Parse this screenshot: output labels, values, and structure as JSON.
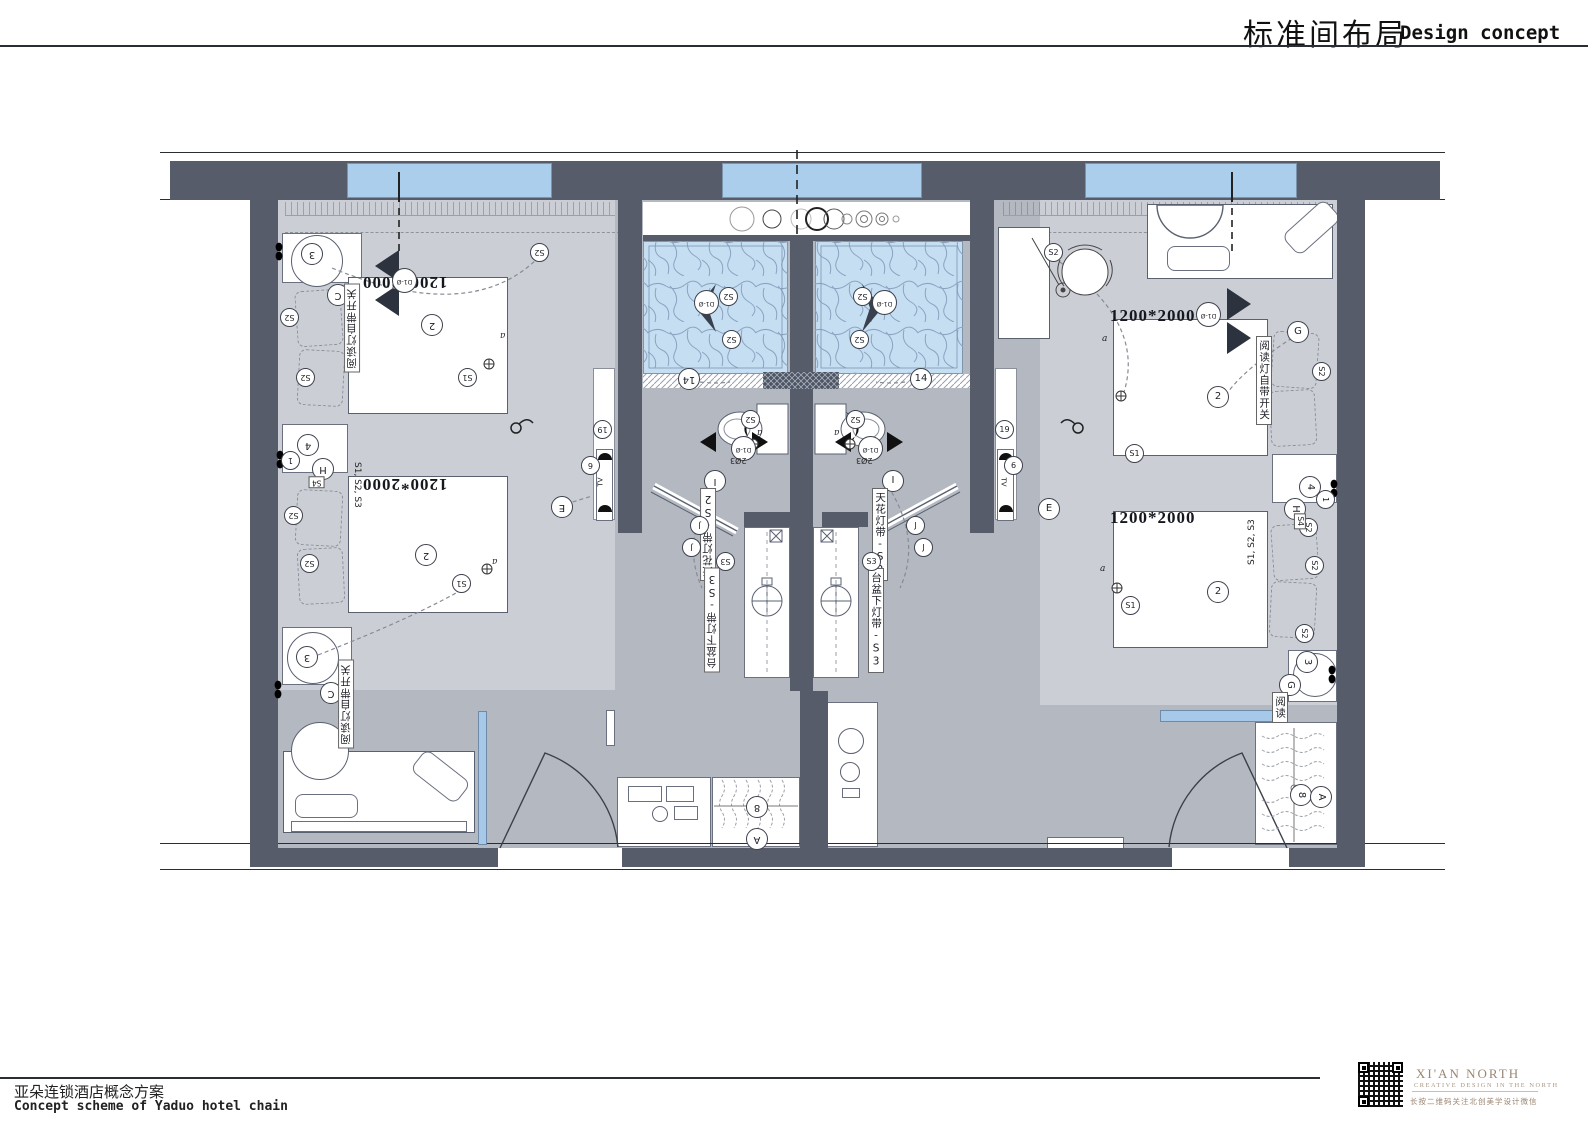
{
  "header": {
    "title_cn": "标准间布局",
    "title_en": "Design concept"
  },
  "footer": {
    "project_cn": "亚朵连锁酒店概念方案",
    "project_en": "Concept scheme of Yaduo hotel chain"
  },
  "brand": {
    "name": "XI'AN NORTH",
    "tagline": "CREATIVE DESIGN IN THE NORTH",
    "wechat_note": "长按二维码关注北创美学设计微信"
  },
  "plan": {
    "bed_size": "1200*2000",
    "reading_lamp_note": "阅读灯自带开关",
    "reading_short": "阅读",
    "ceiling_strip": "天花灯带-S2",
    "basin_strip": "台盆下灯带-S3",
    "switch_group": "S1, S2, S3",
    "door_mark": "D1-Ø",
    "toilet_mark": "2Ø3",
    "tv": "TV",
    "circles": {
      "n1": "1",
      "n2": "2",
      "n3": "3",
      "n4": "4",
      "n6": "6",
      "n8": "8",
      "n14": "14",
      "n19": "19",
      "a": "A",
      "c": "C",
      "e": "E",
      "g": "G",
      "h": "H",
      "i": "I",
      "j": "J"
    },
    "tags": {
      "s1": "S1",
      "s2": "S2",
      "s3": "S3",
      "s4": "S4",
      "sw_a": "a"
    }
  },
  "colors": {
    "wall": "#565c6a",
    "window": "#abceec",
    "floor_light": "#cbcfd5",
    "floor_dark": "#b4b8c1",
    "shower": "#c6def2",
    "accent": "#a6c9e9",
    "brand_text": "#9b8672"
  }
}
